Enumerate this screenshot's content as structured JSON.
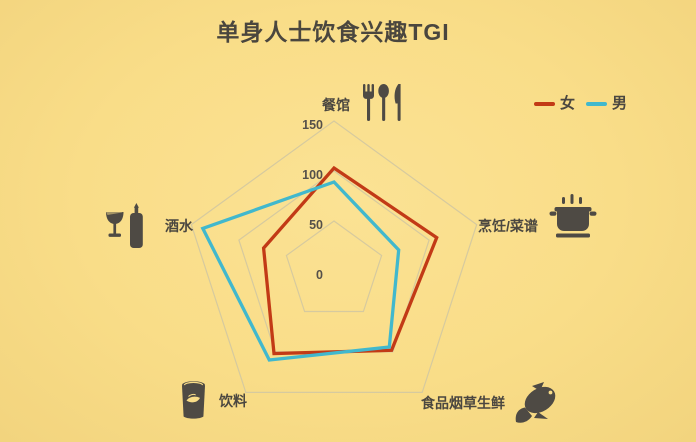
{
  "page": {
    "background": "#f9dd88"
  },
  "title": {
    "text": "单身人士饮食兴趣TGI",
    "color": "#4a463e"
  },
  "legend": [
    {
      "key": "female",
      "label": "女",
      "color": "#c23a16"
    },
    {
      "key": "male",
      "label": "男",
      "color": "#41b8cd"
    }
  ],
  "chart_data": {
    "type": "radar",
    "title": "单身人士饮食兴趣TGI",
    "categories": [
      "餐馆",
      "烹饪/菜谱",
      "食品烟草生鲜",
      "饮料",
      "酒水"
    ],
    "category_icons": [
      "cutlery-icon",
      "cooking-pot-icon",
      "fish-icon",
      "beverage-can-icon",
      "wine-icon"
    ],
    "series": [
      {
        "key": "female",
        "name": "女",
        "color": "#c23a16",
        "values": [
          103,
          108,
          98,
          102,
          74
        ]
      },
      {
        "key": "male",
        "name": "男",
        "color": "#41b8cd",
        "values": [
          89,
          68,
          94,
          110,
          138
        ]
      }
    ],
    "ticks": [
      0,
      50,
      100,
      150
    ],
    "axis_range": [
      0,
      150
    ],
    "grid": "concentric-pentagons",
    "grid_color": "#d6ca9f",
    "legend_position": "top-right",
    "background_color": "#f9dd88"
  }
}
